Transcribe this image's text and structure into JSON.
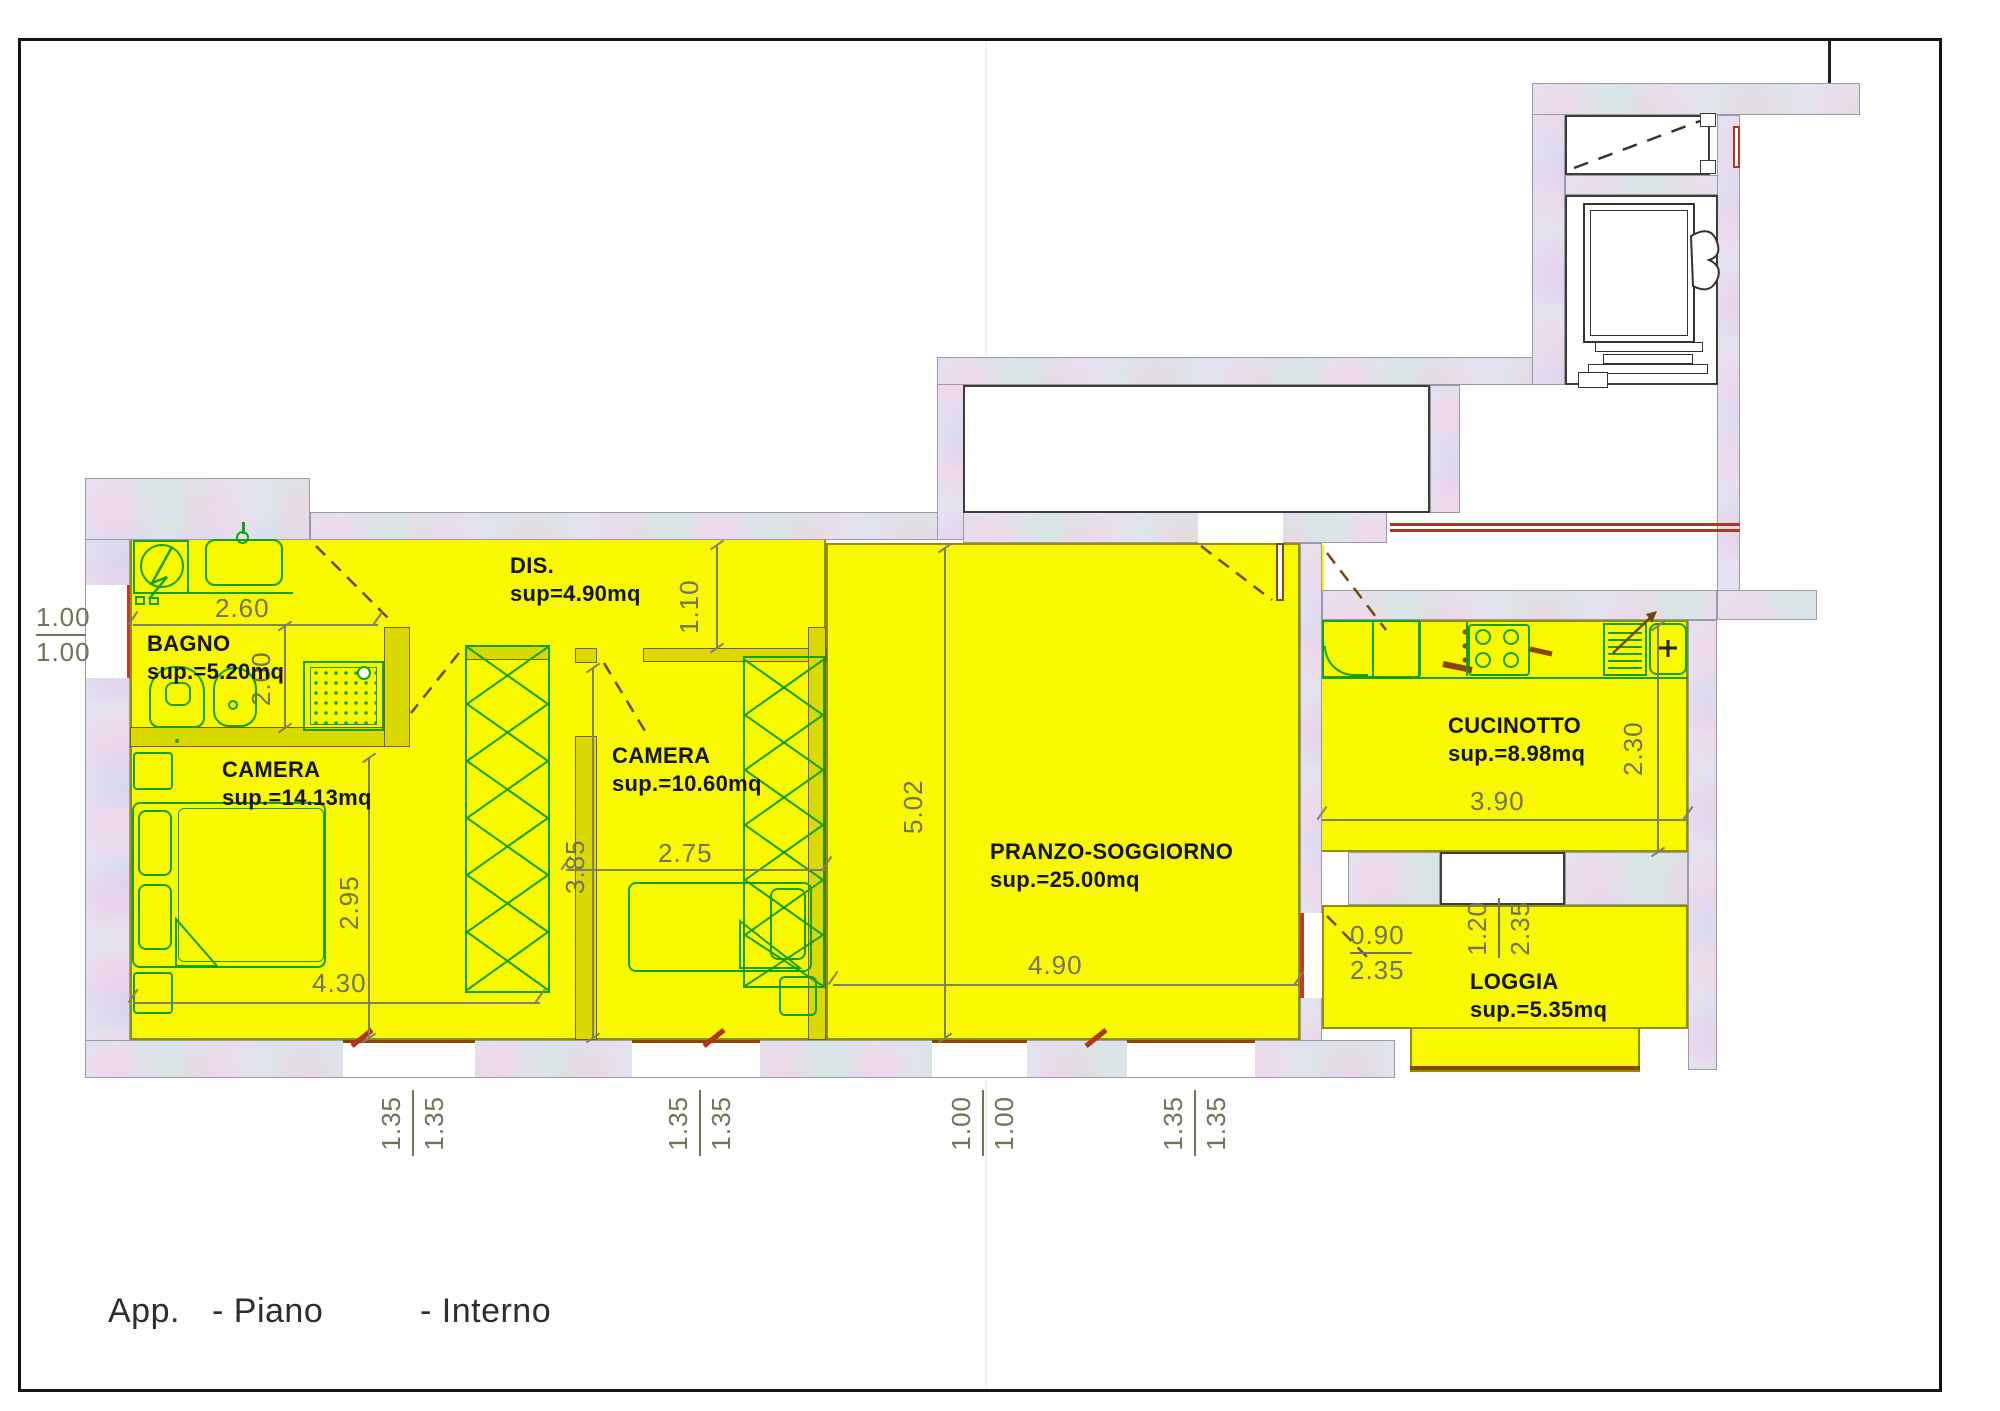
{
  "plan": {
    "caption": {
      "app": "App.",
      "piano": "- Piano",
      "interno": "- Interno"
    },
    "rooms": [
      {
        "id": "bagno",
        "name": "BAGNO",
        "area": "sup.=5.20mq"
      },
      {
        "id": "disimpegno",
        "name": "DIS.",
        "area": "sup=4.90mq"
      },
      {
        "id": "camera1",
        "name": "CAMERA",
        "area": "sup.=14.13mq"
      },
      {
        "id": "camera2",
        "name": "CAMERA",
        "area": "sup.=10.60mq"
      },
      {
        "id": "pranzo",
        "name": "PRANZO-SOGGIORNO",
        "area": "sup.=25.00mq"
      },
      {
        "id": "cucinotto",
        "name": "CUCINOTTO",
        "area": "sup.=8.98mq"
      },
      {
        "id": "loggia",
        "name": "LOGGIA",
        "area": "sup.=5.35mq"
      }
    ],
    "dims": {
      "bagno_w": "2.60",
      "bagno_h": "2.00",
      "dis_h": "1.10",
      "camera1_h": "2.95",
      "camera1_w": "4.30",
      "camera2_h": "3.85",
      "camera2_w": "2.75",
      "pranzo_h": "5.02",
      "pranzo_w": "4.90",
      "cucinotto_w": "3.90",
      "cucinotto_h": "2.30"
    },
    "fractions": {
      "left_window": [
        "1.00",
        "1.00"
      ],
      "w1": [
        "1.35",
        "1.35"
      ],
      "w2": [
        "1.35",
        "1.35"
      ],
      "w3": [
        "1.00",
        "1.00"
      ],
      "w4": [
        "1.35",
        "1.35"
      ],
      "loggia_door": [
        "0.90",
        "2.35"
      ],
      "loggia_window": [
        "1.20",
        "2.35"
      ]
    },
    "colors": {
      "floor": "#f8f800",
      "wall": "#e3e2ee",
      "furniture": "#17a017",
      "wood": "#8a4500",
      "red": "#c23b24",
      "dim_text": "#73735b"
    }
  }
}
